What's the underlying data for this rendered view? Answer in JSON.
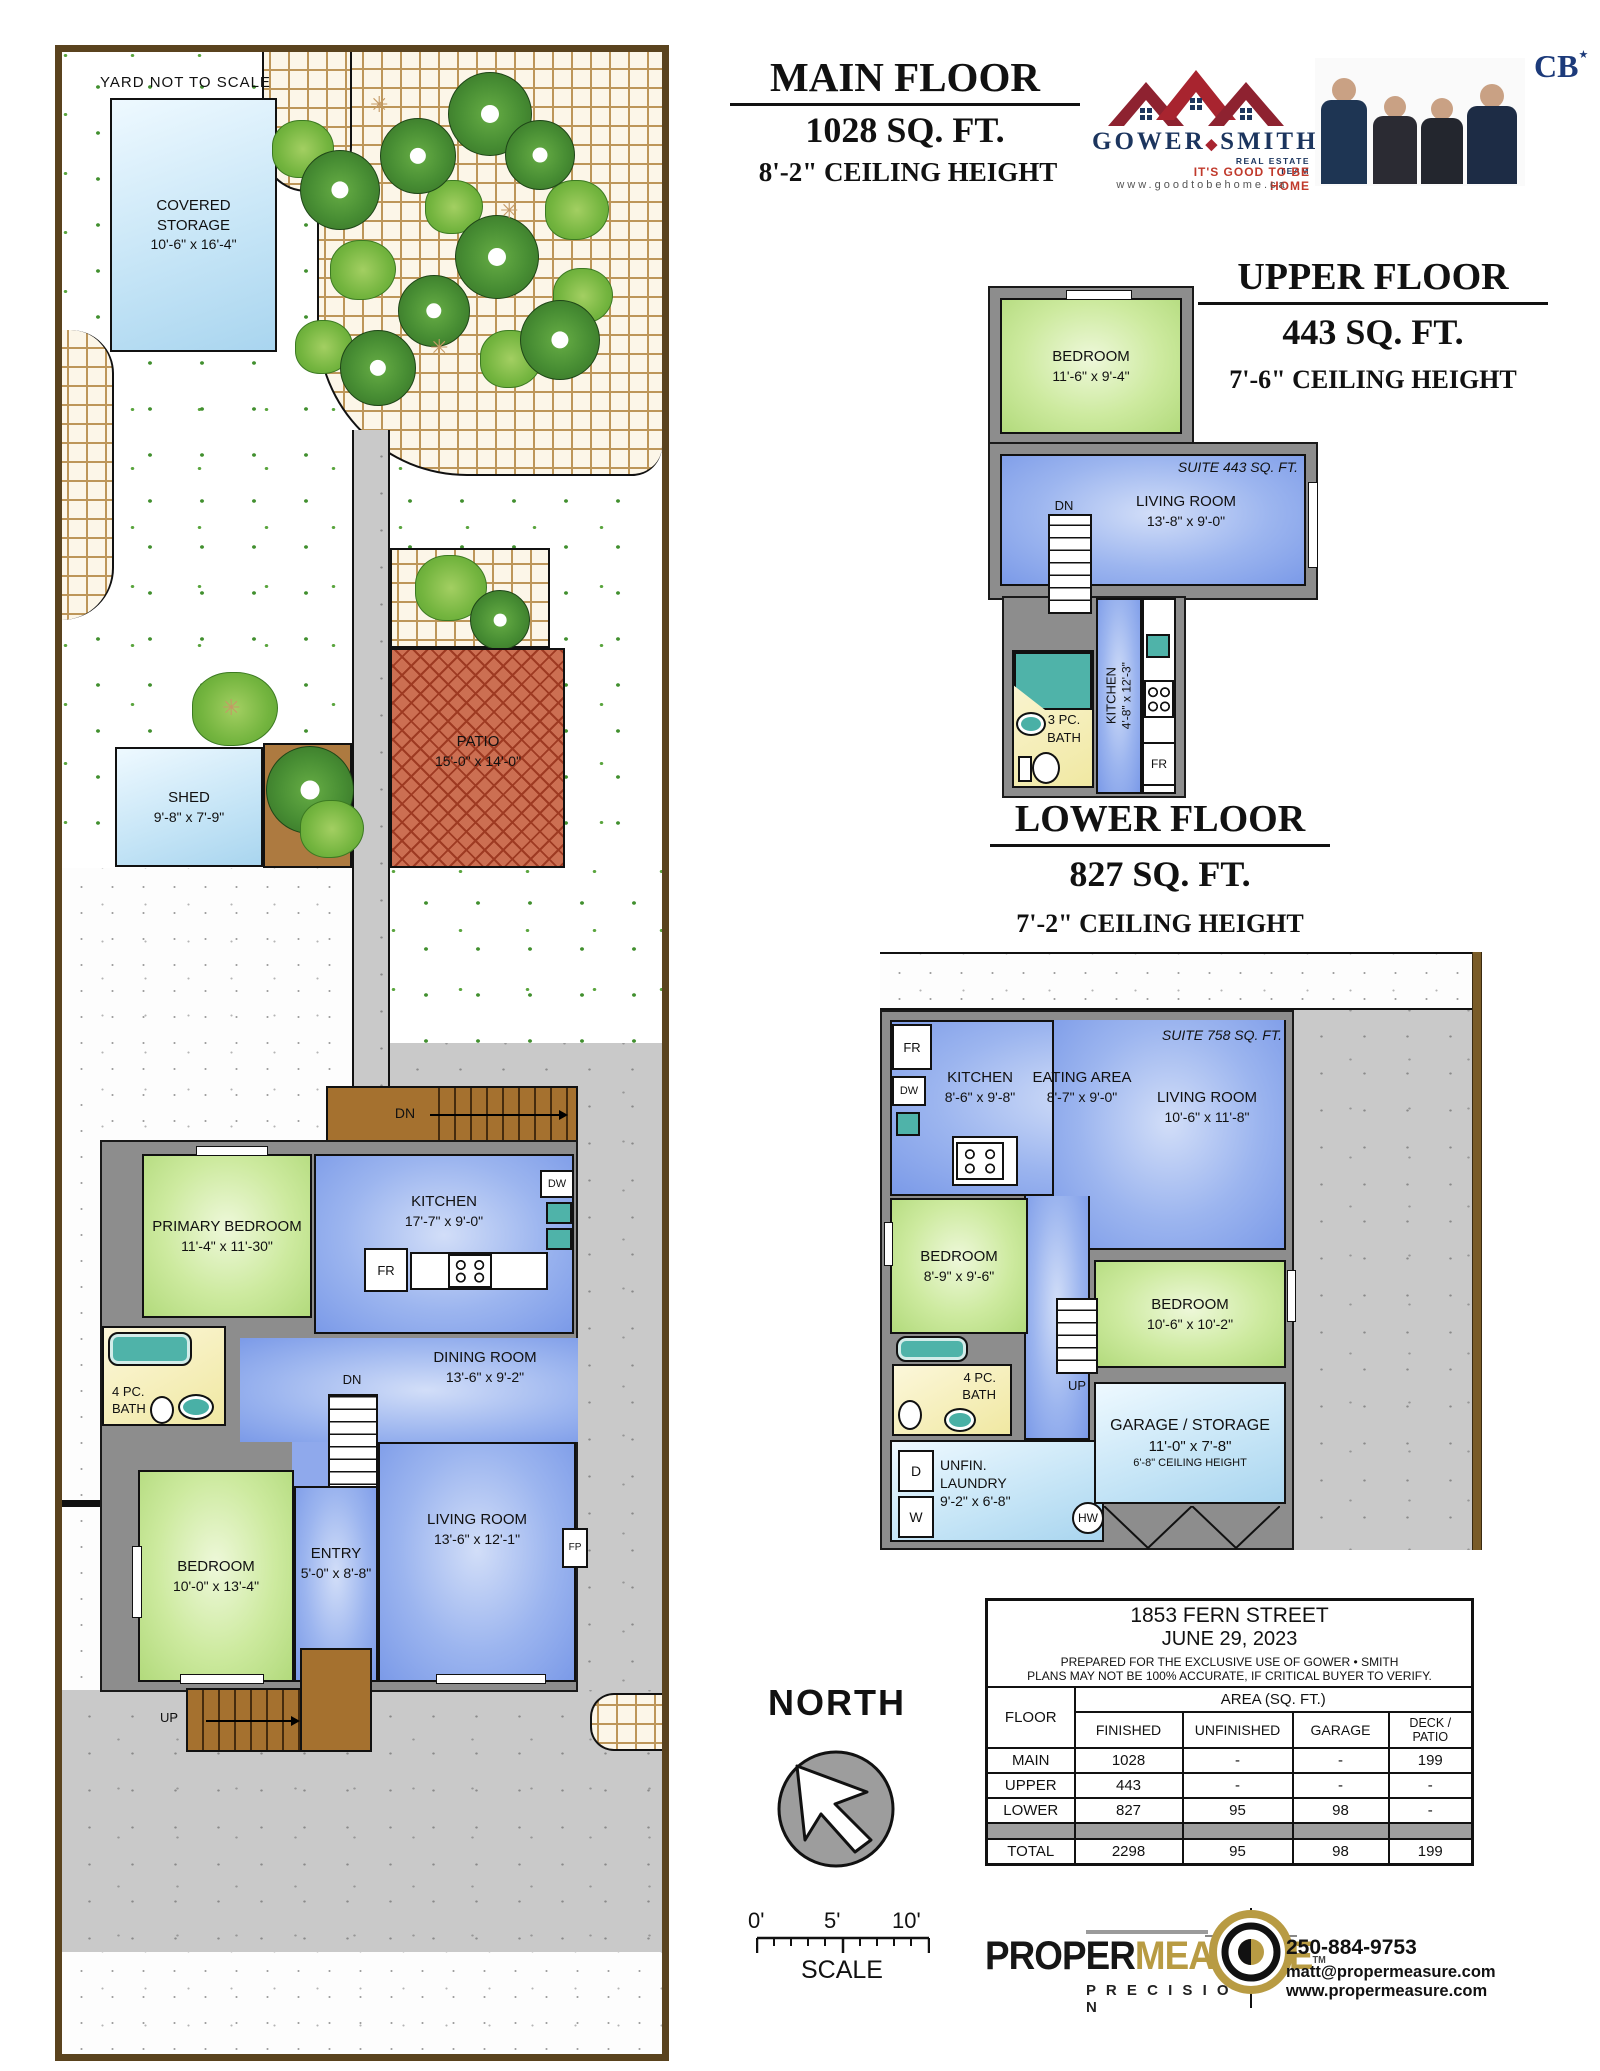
{
  "yard": {
    "not_to_scale": "YARD NOT TO SCALE",
    "covered_storage": {
      "name": "COVERED STORAGE",
      "dims": "10'-6\" x 16'-4\""
    },
    "shed": {
      "name": "SHED",
      "dims": "9'-8\" x 7'-9\""
    },
    "patio": {
      "name": "PATIO",
      "dims": "15'-0\" x 14'-0\""
    }
  },
  "headers": {
    "main": {
      "title": "MAIN FLOOR",
      "area": "1028 SQ. FT.",
      "ceiling": "8'-2\" CEILING HEIGHT"
    },
    "upper": {
      "title": "UPPER FLOOR",
      "area": "443 SQ. FT.",
      "ceiling": "7'-6\" CEILING HEIGHT"
    },
    "lower": {
      "title": "LOWER FLOOR",
      "area": "827 SQ. FT.",
      "ceiling": "7'-2\" CEILING HEIGHT"
    }
  },
  "brand": {
    "name1": "GOWER",
    "diamond": "◆",
    "name2": "SMITH",
    "team": "REAL ESTATE TEAM",
    "slogan": "IT'S GOOD TO BE HOME",
    "website": "www.goodtobehome.ca",
    "cb": "CB",
    "cb_star": "★"
  },
  "main_floor": {
    "rooms": {
      "primary_bedroom": {
        "name": "PRIMARY BEDROOM",
        "dims": "11'-4\" x 11'-30\""
      },
      "kitchen": {
        "name": "KITCHEN",
        "dims": "17'-7\" x 9'-0\""
      },
      "bath": {
        "line1": "4 PC.",
        "line2": "BATH"
      },
      "dining": {
        "name": "DINING ROOM",
        "dims": "13'-6\" x 9'-2\""
      },
      "bedroom": {
        "name": "BEDROOM",
        "dims": "10'-0\" x 13'-4\""
      },
      "entry": {
        "name": "ENTRY",
        "dims": "5'-0\" x 8'-8\""
      },
      "living": {
        "name": "LIVING ROOM",
        "dims": "13'-6\" x 12'-1\""
      }
    },
    "labels": {
      "dn_deck": "DN",
      "dn": "DN",
      "up": "UP",
      "up_walk": "UP",
      "fr": "FR",
      "dw": "DW",
      "fp": "FP"
    }
  },
  "upper_floor": {
    "suite": "SUITE 443 SQ. FT.",
    "rooms": {
      "bedroom": {
        "name": "BEDROOM",
        "dims": "11'-6\" x 9'-4\""
      },
      "living": {
        "name": "LIVING ROOM",
        "dims": "13'-8\" x 9'-0\""
      },
      "kitchen": {
        "name": "KITCHEN",
        "dims": "4'-8\" x 12'-3\""
      },
      "bath": {
        "line1": "3 PC.",
        "line2": "BATH"
      }
    },
    "labels": {
      "dn": "DN",
      "fr": "FR"
    }
  },
  "lower_floor": {
    "suite": "SUITE 758 SQ. FT.",
    "rooms": {
      "kitchen": {
        "name": "KITCHEN",
        "dims": "8'-6\" x 9'-8\""
      },
      "eating": {
        "name": "EATING AREA",
        "dims": "8'-7\" x 9'-0\""
      },
      "living": {
        "name": "LIVING ROOM",
        "dims": "10'-6\" x 11'-8\""
      },
      "bedroom_left": {
        "name": "BEDROOM",
        "dims": "8'-9\" x 9'-6\""
      },
      "bedroom_right": {
        "name": "BEDROOM",
        "dims": "10'-6\" x 10'-2\""
      },
      "bath": {
        "line1": "4 PC.",
        "line2": "BATH"
      },
      "laundry": {
        "line1": "UNFIN.",
        "line2": "LAUNDRY",
        "dims": "9'-2\" x 6'-8\""
      },
      "garage": {
        "name": "GARAGE / STORAGE",
        "dims": "11'-0\" x 7'-8\"",
        "ceiling": "6'-8\" CEILING HEIGHT"
      }
    },
    "labels": {
      "fr": "FR",
      "dw": "DW",
      "d": "D",
      "w": "W",
      "hw": "HW",
      "up": "UP"
    }
  },
  "info_table": {
    "address": "1853 FERN STREET",
    "date": "JUNE 29, 2023",
    "note1": "PREPARED FOR THE EXCLUSIVE USE OF GOWER • SMITH",
    "note2": "PLANS MAY NOT BE 100% ACCURATE, IF CRITICAL BUYER TO VERIFY.",
    "col_floor": "FLOOR",
    "area_header": "AREA (SQ. FT.)",
    "cols": [
      "FINISHED",
      "UNFINISHED",
      "GARAGE",
      "DECK / PATIO"
    ],
    "rows": [
      {
        "floor": "MAIN",
        "finished": "1028",
        "unfinished": "-",
        "garage": "-",
        "deck": "199"
      },
      {
        "floor": "UPPER",
        "finished": "443",
        "unfinished": "-",
        "garage": "-",
        "deck": "-"
      },
      {
        "floor": "LOWER",
        "finished": "827",
        "unfinished": "95",
        "garage": "98",
        "deck": "-"
      },
      {
        "floor": "TOTAL",
        "finished": "2298",
        "unfinished": "95",
        "garage": "98",
        "deck": "199"
      }
    ]
  },
  "compass": {
    "label": "NORTH"
  },
  "scale_bar": {
    "t0": "0'",
    "t5": "5'",
    "t10": "10'",
    "label": "SCALE"
  },
  "propermeasure": {
    "word1": "PROPER",
    "word2": "MEASURE",
    "tm": "TM",
    "precision": "P R E C I S I O N",
    "phone": "250-884-9753",
    "email": "matt@propermeasure.com",
    "web": "www.propermeasure.com"
  }
}
